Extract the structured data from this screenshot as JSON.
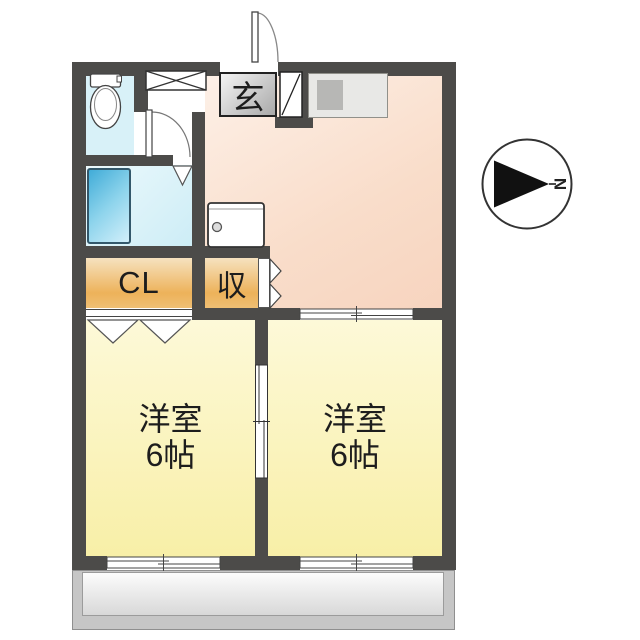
{
  "plan": {
    "type": "apartment-floor-plan",
    "entrance": {
      "label": "玄"
    },
    "closet": {
      "label": "CL"
    },
    "storage": {
      "label": "収"
    },
    "bedroom1": {
      "name": "洋室",
      "size": "6帖"
    },
    "bedroom2": {
      "name": "洋室",
      "size": "6帖"
    },
    "compass": {
      "north_label": "N",
      "direction": "right"
    },
    "fixtures": [
      "toilet",
      "bathtub",
      "kitchen-counter-with-sink",
      "washer-pan",
      "shoe-cabinet",
      "pipe-space"
    ]
  },
  "colors": {
    "wall": "#4c4b49",
    "kitchen_dining": "#f9ddca",
    "toilet_bath": "#d8f1f8",
    "bathtub": "#41acd8",
    "closet_storage": "#edb25a",
    "bedroom": "#f8efa7",
    "balcony": "#c6c6c6",
    "entrance_box": "#a9a9a9"
  }
}
